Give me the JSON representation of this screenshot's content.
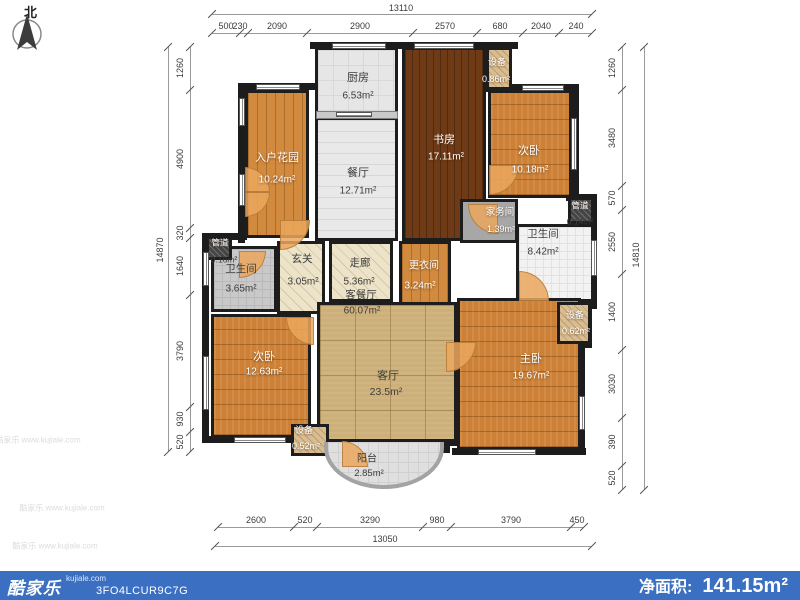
{
  "north": {
    "label": "北"
  },
  "watermarks": [
    {
      "text": "酷家乐 www.kujiale.com",
      "x": 38,
      "y": 440
    },
    {
      "text": "酷家乐 www.kujiale.com",
      "x": 62,
      "y": 508
    },
    {
      "text": "酷家乐 www.kujiale.com",
      "x": 55,
      "y": 546
    }
  ],
  "footer": {
    "bar_color": "#3a6fc1",
    "brand": "酷家乐",
    "site": "kujiale.com",
    "code": "3FO4LCUR9C7G",
    "net_area_label": "净面积:",
    "net_area_value": "141.15m²"
  },
  "plan": {
    "rooms": [
      {
        "id": "kitchen",
        "fill": "tile-k",
        "x": 315,
        "y": 47,
        "w": 83,
        "h": 70
      },
      {
        "id": "dining",
        "fill": "tile-d",
        "x": 315,
        "y": 117,
        "w": 83,
        "h": 124
      },
      {
        "id": "entry-garden",
        "fill": "wood-v",
        "x": 245,
        "y": 90,
        "w": 64,
        "h": 148
      },
      {
        "id": "study",
        "fill": "wood-dark",
        "x": 402,
        "y": 47,
        "w": 84,
        "h": 194
      },
      {
        "id": "laundry",
        "fill": "flat-gray",
        "x": 460,
        "y": 199,
        "w": 58,
        "h": 44
      },
      {
        "id": "equip-top",
        "fill": "hatch-tan",
        "x": 486,
        "y": 47,
        "w": 26,
        "h": 43
      },
      {
        "id": "bedroom-top",
        "fill": "wood-h",
        "x": 488,
        "y": 90,
        "w": 84,
        "h": 108
      },
      {
        "id": "bath-main",
        "fill": "tile-w",
        "x": 516,
        "y": 224,
        "w": 78,
        "h": 78
      },
      {
        "id": "duct-right",
        "fill": "duct",
        "x": 568,
        "y": 197,
        "w": 26,
        "h": 27
      },
      {
        "id": "bath-small",
        "fill": "tile-g",
        "x": 211,
        "y": 246,
        "w": 66,
        "h": 66
      },
      {
        "id": "duct-left",
        "fill": "duct",
        "x": 206,
        "y": 236,
        "w": 26,
        "h": 24
      },
      {
        "id": "foyer",
        "fill": "hatch-beige",
        "x": 277,
        "y": 241,
        "w": 48,
        "h": 73
      },
      {
        "id": "corridor",
        "fill": "hatch-beige",
        "x": 329,
        "y": 241,
        "w": 64,
        "h": 61
      },
      {
        "id": "dressing",
        "fill": "wood-v",
        "x": 399,
        "y": 241,
        "w": 52,
        "h": 73
      },
      {
        "id": "living",
        "fill": "tile-tan",
        "x": 317,
        "y": 302,
        "w": 140,
        "h": 140
      },
      {
        "id": "bedroom-bottom",
        "fill": "wood-h",
        "x": 211,
        "y": 314,
        "w": 100,
        "h": 124
      },
      {
        "id": "equip-bl",
        "fill": "hatch-tan",
        "x": 291,
        "y": 424,
        "w": 38,
        "h": 32
      },
      {
        "id": "master",
        "fill": "wood-h",
        "x": 457,
        "y": 298,
        "w": 124,
        "h": 152
      },
      {
        "id": "equip-br",
        "fill": "hatch-tan",
        "x": 557,
        "y": 302,
        "w": 34,
        "h": 42
      },
      {
        "id": "balcony",
        "fill": "balc",
        "x": 324,
        "y": 442,
        "w": 120,
        "h": 47
      }
    ],
    "labels": [
      {
        "id": "kitchen-name",
        "t": "厨房",
        "x": 358,
        "y": 78,
        "c": "ld",
        "s": 11
      },
      {
        "id": "kitchen-area",
        "t": "6.53m²",
        "x": 358,
        "y": 96,
        "c": "ld",
        "s": 10
      },
      {
        "id": "dining-name",
        "t": "餐厅",
        "x": 358,
        "y": 173,
        "c": "ld",
        "s": 11
      },
      {
        "id": "dining-area",
        "t": "12.71m²",
        "x": 358,
        "y": 191,
        "c": "ld",
        "s": 10
      },
      {
        "id": "entry-garden-name",
        "t": "入户花园",
        "x": 277,
        "y": 158,
        "c": "lw",
        "s": 11
      },
      {
        "id": "entry-garden-area",
        "t": "10.24m²",
        "x": 277,
        "y": 180,
        "c": "lw",
        "s": 10
      },
      {
        "id": "study-name",
        "t": "书房",
        "x": 444,
        "y": 140,
        "c": "lw",
        "s": 11
      },
      {
        "id": "study-area",
        "t": "17.11m²",
        "x": 446,
        "y": 157,
        "c": "lw",
        "s": 10
      },
      {
        "id": "equip-top-name",
        "t": "设备",
        "x": 497,
        "y": 63,
        "c": "lw",
        "s": 9
      },
      {
        "id": "equip-top-area",
        "t": "0.86m²",
        "x": 496,
        "y": 80,
        "c": "lw",
        "s": 9
      },
      {
        "id": "bedroom-top-name",
        "t": "次卧",
        "x": 529,
        "y": 151,
        "c": "lw",
        "s": 11
      },
      {
        "id": "bedroom-top-area",
        "t": "10.18m²",
        "x": 530,
        "y": 170,
        "c": "lw",
        "s": 10
      },
      {
        "id": "duct-right-name",
        "t": "管道",
        "x": 580,
        "y": 206,
        "c": "lw",
        "s": 8.5
      },
      {
        "id": "duct-right-area",
        "t": "0.14m²",
        "x": 580,
        "y": 222,
        "c": "ld",
        "s": 8.5
      },
      {
        "id": "laundry-name",
        "t": "家务间",
        "x": 500,
        "y": 213,
        "c": "lw",
        "s": 9.5
      },
      {
        "id": "laundry-area",
        "t": "1.39m²",
        "x": 501,
        "y": 230,
        "c": "lw",
        "s": 9
      },
      {
        "id": "bath-main-name",
        "t": "卫生间",
        "x": 543,
        "y": 235,
        "c": "ld",
        "s": 10.5
      },
      {
        "id": "bath-main-area",
        "t": "8.42m²",
        "x": 543,
        "y": 252,
        "c": "ld",
        "s": 10
      },
      {
        "id": "duct-left-name",
        "t": "管道",
        "x": 220,
        "y": 243,
        "c": "lw",
        "s": 8.5
      },
      {
        "id": "duct-left-area",
        "t": "0.16m²",
        "x": 224,
        "y": 260,
        "c": "ld",
        "s": 8.5
      },
      {
        "id": "bath-small-name",
        "t": "卫生间",
        "x": 241,
        "y": 270,
        "c": "ld",
        "s": 10.5
      },
      {
        "id": "bath-small-area",
        "t": "3.65m²",
        "x": 241,
        "y": 289,
        "c": "ld",
        "s": 10
      },
      {
        "id": "foyer-name",
        "t": "玄关",
        "x": 302,
        "y": 260,
        "c": "ld",
        "s": 10.5
      },
      {
        "id": "foyer-area",
        "t": "3.05m²",
        "x": 303,
        "y": 282,
        "c": "ld",
        "s": 10
      },
      {
        "id": "corridor-name",
        "t": "走廊",
        "x": 360,
        "y": 264,
        "c": "ld",
        "s": 10.5
      },
      {
        "id": "corridor-area",
        "t": "5.36m²",
        "x": 359,
        "y": 282,
        "c": "ld",
        "s": 10
      },
      {
        "id": "living-dining-name",
        "t": "客餐厅",
        "x": 361,
        "y": 296,
        "c": "ld",
        "s": 10.5
      },
      {
        "id": "living-dining-area",
        "t": "60.07m²",
        "x": 362,
        "y": 311,
        "c": "ld",
        "s": 10
      },
      {
        "id": "dressing-name",
        "t": "更衣间",
        "x": 424,
        "y": 266,
        "c": "lw",
        "s": 10
      },
      {
        "id": "dressing-area",
        "t": "3.24m²",
        "x": 420,
        "y": 286,
        "c": "lw",
        "s": 10
      },
      {
        "id": "living-name",
        "t": "客厅",
        "x": 388,
        "y": 376,
        "c": "ld",
        "s": 11
      },
      {
        "id": "living-area",
        "t": "23.5m²",
        "x": 386,
        "y": 393,
        "c": "ld",
        "s": 10.5
      },
      {
        "id": "bedroom-bottom-name",
        "t": "次卧",
        "x": 264,
        "y": 357,
        "c": "lw",
        "s": 11
      },
      {
        "id": "bedroom-bottom-area",
        "t": "12.63m²",
        "x": 264,
        "y": 372,
        "c": "lw",
        "s": 10
      },
      {
        "id": "equip-bl-name",
        "t": "设备",
        "x": 304,
        "y": 431,
        "c": "lw",
        "s": 9
      },
      {
        "id": "equip-bl-area",
        "t": "0.52m²",
        "x": 306,
        "y": 447,
        "c": "lw",
        "s": 9
      },
      {
        "id": "balcony-name",
        "t": "阳台",
        "x": 367,
        "y": 459,
        "c": "ld",
        "s": 10
      },
      {
        "id": "balcony-area",
        "t": "2.85m²",
        "x": 369,
        "y": 474,
        "c": "ld",
        "s": 9.5
      },
      {
        "id": "master-name",
        "t": "主卧",
        "x": 531,
        "y": 359,
        "c": "lw",
        "s": 11
      },
      {
        "id": "master-area",
        "t": "19.67m²",
        "x": 531,
        "y": 376,
        "c": "lw",
        "s": 10
      },
      {
        "id": "equip-br-name",
        "t": "设备",
        "x": 575,
        "y": 316,
        "c": "lw",
        "s": 9
      },
      {
        "id": "equip-br-area",
        "t": "0.62m²",
        "x": 576,
        "y": 332,
        "c": "lw",
        "s": 9
      }
    ],
    "walls": [
      [
        310,
        42,
        208,
        7
      ],
      [
        240,
        83,
        75,
        7
      ],
      [
        238,
        83,
        7,
        160
      ],
      [
        202,
        233,
        45,
        7
      ],
      [
        202,
        233,
        7,
        210
      ],
      [
        202,
        436,
        116,
        7
      ],
      [
        508,
        84,
        71,
        7
      ],
      [
        572,
        84,
        7,
        117
      ],
      [
        566,
        194,
        31,
        7
      ],
      [
        590,
        194,
        7,
        115
      ],
      [
        554,
        299,
        43,
        7
      ],
      [
        585,
        299,
        7,
        49
      ],
      [
        578,
        343,
        7,
        112
      ],
      [
        452,
        448,
        134,
        7
      ],
      [
        311,
        439,
        32,
        7
      ],
      [
        370,
        439,
        90,
        7
      ],
      [
        316,
        439,
        8,
        14
      ],
      [
        442,
        439,
        8,
        14
      ],
      [
        484,
        42,
        7,
        50
      ]
    ],
    "windows_h": [
      [
        256,
        84,
        44,
        6
      ],
      [
        332,
        43,
        54,
        6
      ],
      [
        414,
        43,
        60,
        6
      ],
      [
        522,
        85,
        42,
        6
      ],
      [
        234,
        437,
        52,
        6
      ],
      [
        478,
        449,
        58,
        6
      ],
      [
        336,
        112,
        36,
        5
      ]
    ],
    "windows_v": [
      [
        239,
        98,
        6,
        28
      ],
      [
        239,
        174,
        6,
        32
      ],
      [
        203,
        252,
        6,
        34
      ],
      [
        203,
        356,
        6,
        54
      ],
      [
        579,
        396,
        6,
        34
      ],
      [
        571,
        118,
        6,
        52
      ],
      [
        591,
        240,
        6,
        36
      ]
    ],
    "doors": [
      {
        "x": 280,
        "y": 220,
        "s": 30,
        "k": "br"
      },
      {
        "x": 468,
        "y": 204,
        "s": 30,
        "k": "bl"
      },
      {
        "x": 489,
        "y": 165,
        "s": 30,
        "k": "br"
      },
      {
        "x": 519,
        "y": 271,
        "s": 30,
        "k": "tr"
      },
      {
        "x": 239,
        "y": 251,
        "s": 27,
        "k": "br"
      },
      {
        "x": 286,
        "y": 317,
        "s": 28,
        "k": "bl"
      },
      {
        "x": 446,
        "y": 342,
        "s": 30,
        "k": "br"
      },
      {
        "x": 342,
        "y": 441,
        "s": 26,
        "k": "tr"
      },
      {
        "x": 245,
        "y": 167,
        "s": 25,
        "k": "tr"
      },
      {
        "x": 245,
        "y": 192,
        "s": 25,
        "k": "br"
      }
    ],
    "divider": {
      "x": 316,
      "y": 111,
      "w": 82,
      "h": 8
    }
  },
  "dims": {
    "top": {
      "total": {
        "v": "13110",
        "x1": 212,
        "x2": 592,
        "ly": 14,
        "tx": 401,
        "ty": 8
      },
      "line_y": 33,
      "label_y": 26,
      "ticks": [
        212,
        240,
        248,
        307,
        413,
        477,
        523,
        559,
        592
      ],
      "segments": [
        {
          "v": "500",
          "c": 226
        },
        {
          "v": "230",
          "c": 240
        },
        {
          "v": "2090",
          "c": 277
        },
        {
          "v": "2900",
          "c": 360
        },
        {
          "v": "2570",
          "c": 445
        },
        {
          "v": "680",
          "c": 500
        },
        {
          "v": "2040",
          "c": 541
        },
        {
          "v": "240",
          "c": 576
        }
      ]
    },
    "bottom": {
      "total": {
        "v": "13050",
        "x1": 215,
        "x2": 592,
        "ly": 546,
        "tx": 385,
        "ty": 539
      },
      "line_y": 527,
      "label_y": 520,
      "ticks": [
        218,
        294,
        317,
        423,
        451,
        571,
        584
      ],
      "segments": [
        {
          "v": "2600",
          "c": 256
        },
        {
          "v": "520",
          "c": 305
        },
        {
          "v": "3290",
          "c": 370
        },
        {
          "v": "980",
          "c": 437
        },
        {
          "v": "3790",
          "c": 511
        },
        {
          "v": "450",
          "c": 577
        }
      ]
    },
    "left": {
      "total": {
        "v": "14870",
        "y1": 47,
        "y2": 452,
        "lx": 168,
        "tx": 160,
        "ty": 250
      },
      "line_x": 190,
      "label_x": 180,
      "ticks": [
        47,
        90,
        228,
        238,
        295,
        407,
        432,
        452
      ],
      "segments": [
        {
          "v": "1260",
          "c": 68
        },
        {
          "v": "4900",
          "c": 159
        },
        {
          "v": "320",
          "c": 233
        },
        {
          "v": "1640",
          "c": 266
        },
        {
          "v": "3790",
          "c": 351
        },
        {
          "v": "930",
          "c": 419
        },
        {
          "v": "520",
          "c": 442
        }
      ]
    },
    "right": {
      "total": {
        "v": "14810",
        "y1": 47,
        "y2": 490,
        "lx": 644,
        "tx": 636,
        "ty": 255
      },
      "line_x": 622,
      "label_x": 612,
      "ticks": [
        47,
        90,
        186,
        210,
        274,
        350,
        418,
        466,
        490
      ],
      "segments": [
        {
          "v": "1260",
          "c": 68
        },
        {
          "v": "3480",
          "c": 138
        },
        {
          "v": "570",
          "c": 198
        },
        {
          "v": "2550",
          "c": 242
        },
        {
          "v": "1400",
          "c": 312
        },
        {
          "v": "3030",
          "c": 384
        },
        {
          "v": "390",
          "c": 442
        },
        {
          "v": "520",
          "c": 478
        }
      ]
    }
  }
}
